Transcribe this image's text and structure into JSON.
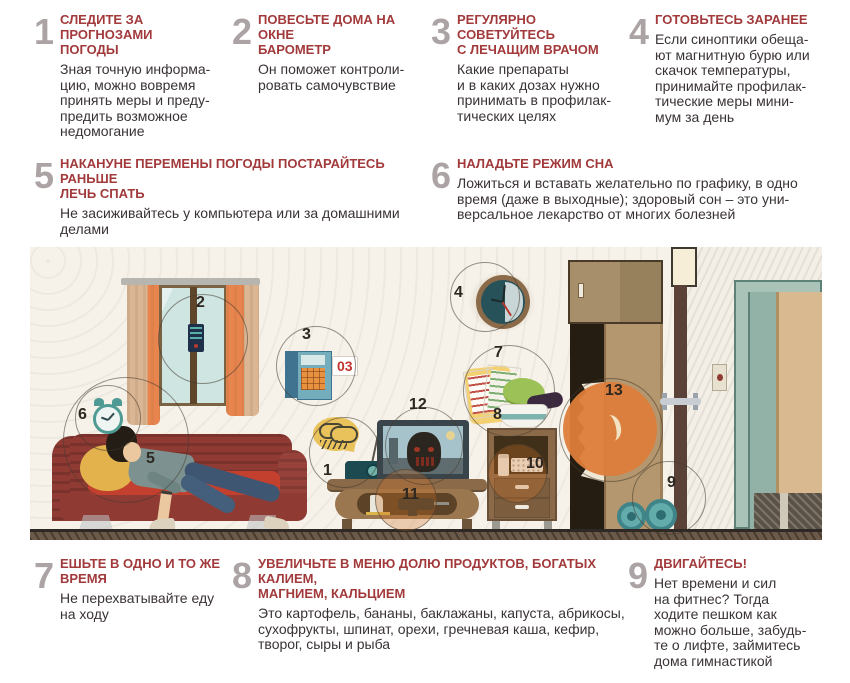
{
  "poster": {
    "language": "ru",
    "topic": "советы для метеочувствительных людей"
  },
  "colors": {
    "accent_red": "#a23a3c",
    "number_gray": "#aca4a4",
    "body_text": "#3a3335",
    "wall": "#f6f2ea",
    "sofa_red": "#8f3a33",
    "orange_highlight": "#dd7d3b",
    "teal": "#5fa8a0"
  },
  "tips": [
    {
      "num": "1",
      "title": "СЛЕДИТЕ ЗА ПРОГНОЗАМИ\nПОГОДЫ",
      "body": "Зная точную информа-\nцию, можно вовремя\nпринять меры и преду-\nпредить возможное\nнедомогание"
    },
    {
      "num": "2",
      "title": "ПОВЕСЬТЕ ДОМА НА ОКНЕ\nБАРОМЕТР",
      "body": "Он поможет контроли-\nровать самочувствие"
    },
    {
      "num": "3",
      "title": "РЕГУЛЯРНО СОВЕТУЙТЕСЬ\nС ЛЕЧАЩИМ ВРАЧОМ",
      "body": "Какие препараты\nи в каких дозах нужно\nпринимать в профилак-\nтических целях"
    },
    {
      "num": "4",
      "title": "ГОТОВЬТЕСЬ ЗАРАНЕЕ",
      "body": "Если синоптики обеща-\nют магнитную бурю или\nскачок температуры,\nпринимайте профилак-\nтические меры мини-\nмум за день"
    },
    {
      "num": "5",
      "title": "НАКАНУНЕ ПЕРЕМЕНЫ ПОГОДЫ ПОСТАРАЙТЕСЬ РАНЬШЕ\nЛЕЧЬ СПАТЬ",
      "body": "Не засиживайтесь у компьютера или за домашними\nделами"
    },
    {
      "num": "6",
      "title": "НАЛАДЬТЕ РЕЖИМ СНА",
      "body": "Ложиться и вставать желательно по графику, в одно\nвремя (даже в выходные); здоровый сон – это уни-\nверсальное лекарство от многих болезней"
    },
    {
      "num": "7",
      "title": "ЕШЬТЕ В ОДНО И ТО ЖЕ\nВРЕМЯ",
      "body": "Не перехватывайте еду\nна ходу"
    },
    {
      "num": "8",
      "title": "УВЕЛИЧЬТЕ В МЕНЮ ДОЛЮ ПРОДУКТОВ, БОГАТЫХ КАЛИЕМ,\nМАГНИЕМ, КАЛЬЦИЕМ",
      "body": "Это картофель, бананы, баклажаны, капуста, абрикосы,\nсухофрукты, шпинат, орехи, гречневая каша, кефир,\nтворог, сыры и рыба"
    },
    {
      "num": "9",
      "title": "ДВИГАЙТЕСЬ!",
      "body": "Нет времени и сил\nна фитнес? Тогда\nходите пешком как\nможно больше, забудь-\nте о лифте, займитесь\nдома гимнастикой"
    }
  ],
  "illustration": {
    "markers": [
      "1",
      "2",
      "3",
      "4",
      "5",
      "6",
      "7",
      "8",
      "9",
      "10",
      "11",
      "12",
      "13"
    ],
    "phone_label": "03"
  }
}
